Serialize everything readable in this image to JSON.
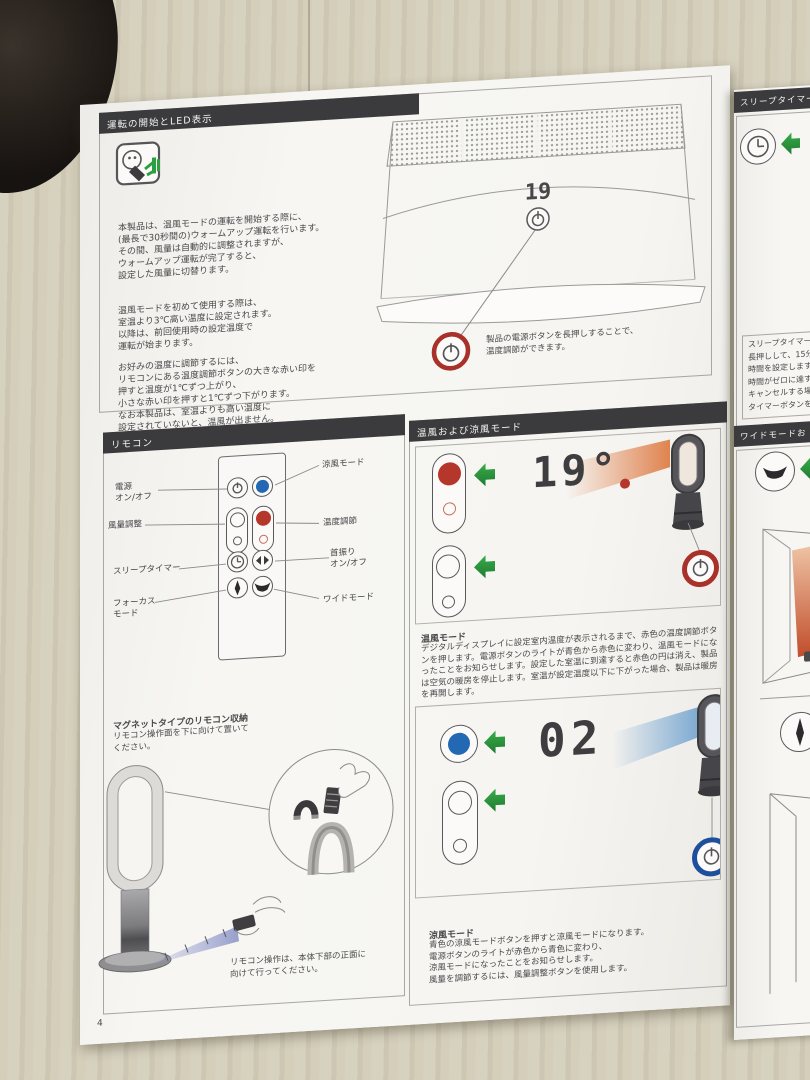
{
  "colors": {
    "header_bar": "#3b3b3d",
    "accent_red": "#b5372b",
    "accent_blue": "#2268b2",
    "accent_green": "#2f9e41",
    "ring_red": "#a83229",
    "ring_blue": "#1d4f9c"
  },
  "page_left": {
    "page_number": "4",
    "operation": {
      "title": "運転の開始とLED表示",
      "para1": "本製品は、温風モードの運転を開始する際に、\n(最長で30秒間の)ウォームアップ運転を行います。\nその間、風量は自動的に調整されますが、\nウォームアップ運転が完了すると、\n設定した風量に切替ります。",
      "para2": "温風モードを初めて使用する際は、\n室温より3℃高い温度に設定されます。\n以降は、前回使用時の設定温度で\n運転が始まります。",
      "para3": "お好みの温度に調節するには、\nリモコンにある温度調節ボタンの大きな赤い印を\n押すと温度が1℃ずつ上がり、\n小さな赤い印を押すと1℃ずつ下がります。\nなお本製品は、室温よりも高い温度に\n設定されていないと、温風が出ません。",
      "display_value": "19",
      "callout": "製品の電源ボタンを長押しすることで、\n温度調節ができます。"
    },
    "remote": {
      "title": "リモコン",
      "labels": {
        "power": "電源\nオン/オフ",
        "airflow": "風量調整",
        "sleep": "スリープタイマー",
        "focus": "フォーカス\nモード",
        "cool": "涼風モード",
        "temp": "温度調節",
        "osc": "首振り\nオン/オフ",
        "wide": "ワイドモード"
      },
      "magnet_title": "マグネットタイプのリモコン収納",
      "magnet_body": "リモコン操作面を下に向けて置いて\nください。",
      "note": "リモコン操作は、本体下部の正面に\n向けて行ってください。"
    },
    "modes": {
      "title": "温風および涼風モード",
      "hot_display": "19°",
      "hot_title": "温風モード",
      "hot_body": "デジタルディスプレイに設定室内温度が表示されるまで、赤色の温度調節ボタンを押します。電源ボタンのライトが青色から赤色に変わり、温風モードになったことをお知らせします。設定した室温に到達すると赤色の円は消え、製品は空気の暖房を停止します。室温が設定温度以下に下がった場合、製品は暖房を再開します。",
      "cool_display": "02",
      "cool_title": "涼風モード",
      "cool_body": "青色の涼風モードボタンを押すと涼風モードになります。\n電源ボタンのライトが赤色から青色に変わり、\n涼風モードになったことをお知らせします。\n風量を調節するには、風量調整ボタンを使用します。"
    }
  },
  "page_right": {
    "sleep_title": "スリープタイマー",
    "sleep_note": "スリープタイマーを\n長押しして、15分単\n時間を設定します\n時間がゼロに達す\nキャンセルする場\nタイマーボタンを",
    "wide_title": "ワイドモードお"
  }
}
